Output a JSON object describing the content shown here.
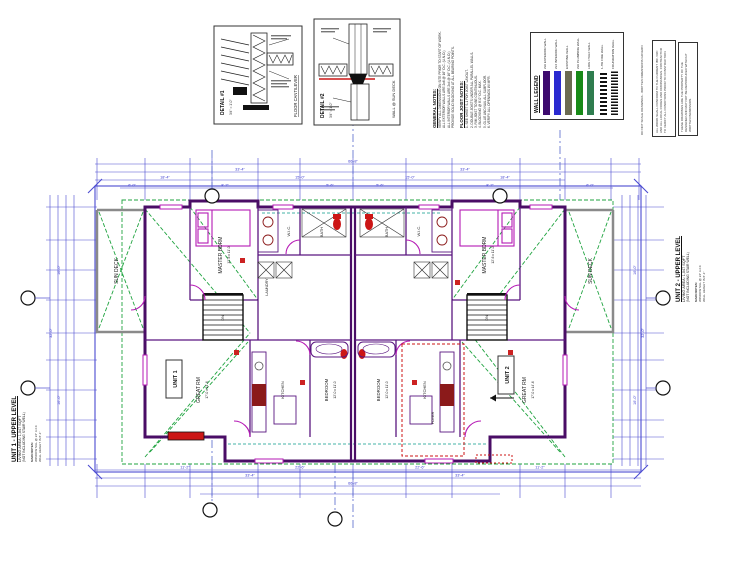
{
  "palette": {
    "dimension_blue": "#4a4ad0",
    "wall_purple": "#4a0d66",
    "fixture_magenta": "#b519b5",
    "roof_green": "#1fa33f",
    "eave_teal": "#0a9b8a",
    "accent_red": "#cc1616",
    "stair_black": "#111111",
    "deck_gray": "#8a8a8a"
  },
  "details": [
    {
      "title": "DETAIL #1",
      "caption": "FLOOR CANTILEVER",
      "scale": "3/4\" = 1'-0\""
    },
    {
      "title": "DETAIL #2",
      "caption": "WALL @ SUN DECK",
      "scale": "3/4\" = 1'-0\""
    }
  ],
  "general_notes": {
    "heading": "GENERAL NOTES:",
    "lines": [
      "VERIFY ALL DIMENSIONS ON SITE PRIOR TO START OF WORK.",
      "ALL EXTERIOR WALLS ARE 2x6 @ 16\" O.C. (U.N.O.)",
      "ALL INTERIOR WALLS ARE 2x4 @ 16\" O.C. (U.N.O.)",
      "PROVIDE SOLID BLOCKING AT ALL BEARING POINTS."
    ],
    "subheading": "FLOOR JOIST NOTES:",
    "sublines": [
      "1. SEE SHEET S-1 FOR JOIST LAYOUT.",
      "2. DOUBLE JOISTS UNDER ALL PARALLEL WALLS.",
      "3. RIM JOIST TO BE CONTINUOUS.",
      "4. BLOCKING @ 8'-0\" O.C. MAX.",
      "5. GLUE AND NAIL ALL SUBFLOOR.",
      "6. VERIFY ALL OPENINGS W/ MFR."
    ]
  },
  "wall_legend": {
    "title": "WALL LEGEND",
    "entries": [
      {
        "label": "2x6 EXTERIOR WALL",
        "color": "#3d0a6e",
        "bar_style": "background:#3d0a6e"
      },
      {
        "label": "2x4 INTERIOR WALL",
        "color": "#2a2ad0",
        "bar_style": "background:#2a2ad0"
      },
      {
        "label": "EXISTING WALL",
        "color": "#6b6b52",
        "bar_style": "background:#6b6b52"
      },
      {
        "label": "2x6 PLUMBING WALL",
        "color": "#188a18",
        "bar_style": "background:#188a18"
      },
      {
        "label": "LOW / HALF WALL",
        "color": "#2f7d4f",
        "bar_style": "background:#2f7d4f"
      },
      {
        "label": "1-HR FIRE WALL",
        "color": "#111111",
        "bar_style": ""
      },
      {
        "label": "FOUNDATION WALL",
        "color": "#111111",
        "bar_style": ""
      }
    ]
  },
  "side_notes": {
    "strip": "DO NOT SCALE DRAWINGS - WRITTEN DIMENSIONS GOVERN",
    "box1": "ALL WORK SHALL CONFORM TO THE CURRENT IBC / IRC AND ALL LOCAL CODES AND ORDINANCES. CONTRACTOR TO VERIFY ALL CONDITIONS PRIOR TO CONSTRUCTION.",
    "box2": "THESE DRAWINGS ARE THE PROPERTY OF THE DESIGNER AND MAY NOT BE REPRODUCED WITHOUT WRITTEN PERMISSION."
  },
  "unit1": {
    "title": "UNIT 1 - UPPER LEVEL",
    "area": "LIVING AREA: 1,047 SQFT",
    "note": "(NOT INCLUDING STAIR WELL)",
    "sub1": "MAIN NOTES:",
    "sub2": "WINDOW SILL @ 24\" A.F.F.",
    "sub3": "WALL HEIGHT IS 8'-1\""
  },
  "unit2": {
    "title": "UNIT 2 - UPPER LEVEL",
    "area": "LIVING AREA: 1,047 SQFT",
    "note": "(NOT INCLUDING STAIR WELL)",
    "sub1": "MAIN NOTES:",
    "sub2": "WINDOW SILL @ 24\" A.F.F.",
    "sub3": "WALL HEIGHT IS 8'-1\""
  },
  "plan": {
    "unit_labels": [
      "UNIT 1",
      "UNIT 2"
    ],
    "rooms": [
      {
        "label": "SUN DECK",
        "size": "8'-0 x 20'-0"
      },
      {
        "label": "MASTER BDRM",
        "size": "12'-6 x 11'-0"
      },
      {
        "label": "W.I.C."
      },
      {
        "label": "BATH"
      },
      {
        "label": "LAUNDRY"
      },
      {
        "label": "GREAT RM",
        "size": "17'-0 x 14'-6"
      },
      {
        "label": "KITCHEN"
      },
      {
        "label": "BEDROOM",
        "size": "12'-0 x 11'-0"
      },
      {
        "label": "BEDROOM",
        "size": "12'-0 x 11'-0"
      },
      {
        "label": "KITCHEN"
      },
      {
        "label": "GREAT RM",
        "size": "17'-0 x 14'-6"
      },
      {
        "label": "BATH"
      },
      {
        "label": "W.I.C."
      },
      {
        "label": "MASTER BDRM",
        "size": "12'-6 x 11'-0"
      },
      {
        "label": "SUN DECK",
        "size": "8'-0 x 20'-0"
      },
      {
        "label": "FOYER"
      },
      {
        "label": "DN"
      },
      {
        "label": "DN"
      }
    ],
    "dims": [
      "66'-8\"",
      "33'-4\"",
      "33'-4\"",
      "18'-4\"",
      "15'-0\"",
      "15'-0\"",
      "18'-4\"",
      "6'-0\"",
      "8'-2\"",
      "5'-6\"",
      "5'-6\"",
      "8'-2\"",
      "6'-0\"",
      "11'-2\"",
      "22'-6\"",
      "22'-6\"",
      "11'-2\"",
      "33'-4\"",
      "33'-4\"",
      "66'-8\"",
      "32'-0\"",
      "16'-0\"",
      "16'-0\"",
      "32'-0\"",
      "16'-0\"",
      "16'-0\""
    ]
  }
}
